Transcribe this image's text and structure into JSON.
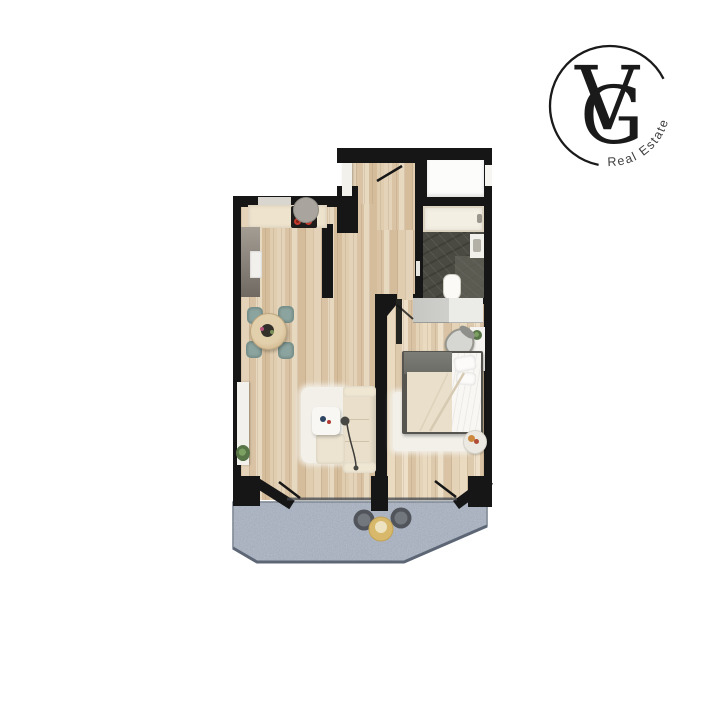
{
  "logo": {
    "monogram_v": "V",
    "monogram_g": "G",
    "tagline": "Real Estate"
  },
  "palette": {
    "wall": "#161616",
    "wood": "#dcc8ab",
    "balcony": "#a8b2c3",
    "bath-tile": "#4b4a42",
    "cream-sofa": "#e9dfca",
    "teal-chair": "#8ca49f",
    "burner-red": "#c23a2e",
    "balcony-table-yellow": "#d8b96c",
    "logo-ink": "#1a1a1a"
  },
  "floorplan": {
    "rooms": [
      {
        "name": "entry-hall"
      },
      {
        "name": "kitchen"
      },
      {
        "name": "living-dining-room"
      },
      {
        "name": "bathroom"
      },
      {
        "name": "closet"
      },
      {
        "name": "bedroom"
      },
      {
        "name": "balcony"
      }
    ],
    "furniture": [
      "kitchen-counter",
      "stove",
      "range-hood",
      "tall-cabinet",
      "fridge",
      "dining-table",
      "dining-chairs",
      "sideboard",
      "plant",
      "area-rug",
      "sofa",
      "coffee-table",
      "floor-lamp",
      "ottoman",
      "bathtub",
      "washbasin",
      "toilet",
      "wardrobe",
      "desk",
      "desk-chair",
      "double-bed",
      "bedside-rug",
      "pet-bowl",
      "balcony-chairs",
      "balcony-table"
    ]
  }
}
